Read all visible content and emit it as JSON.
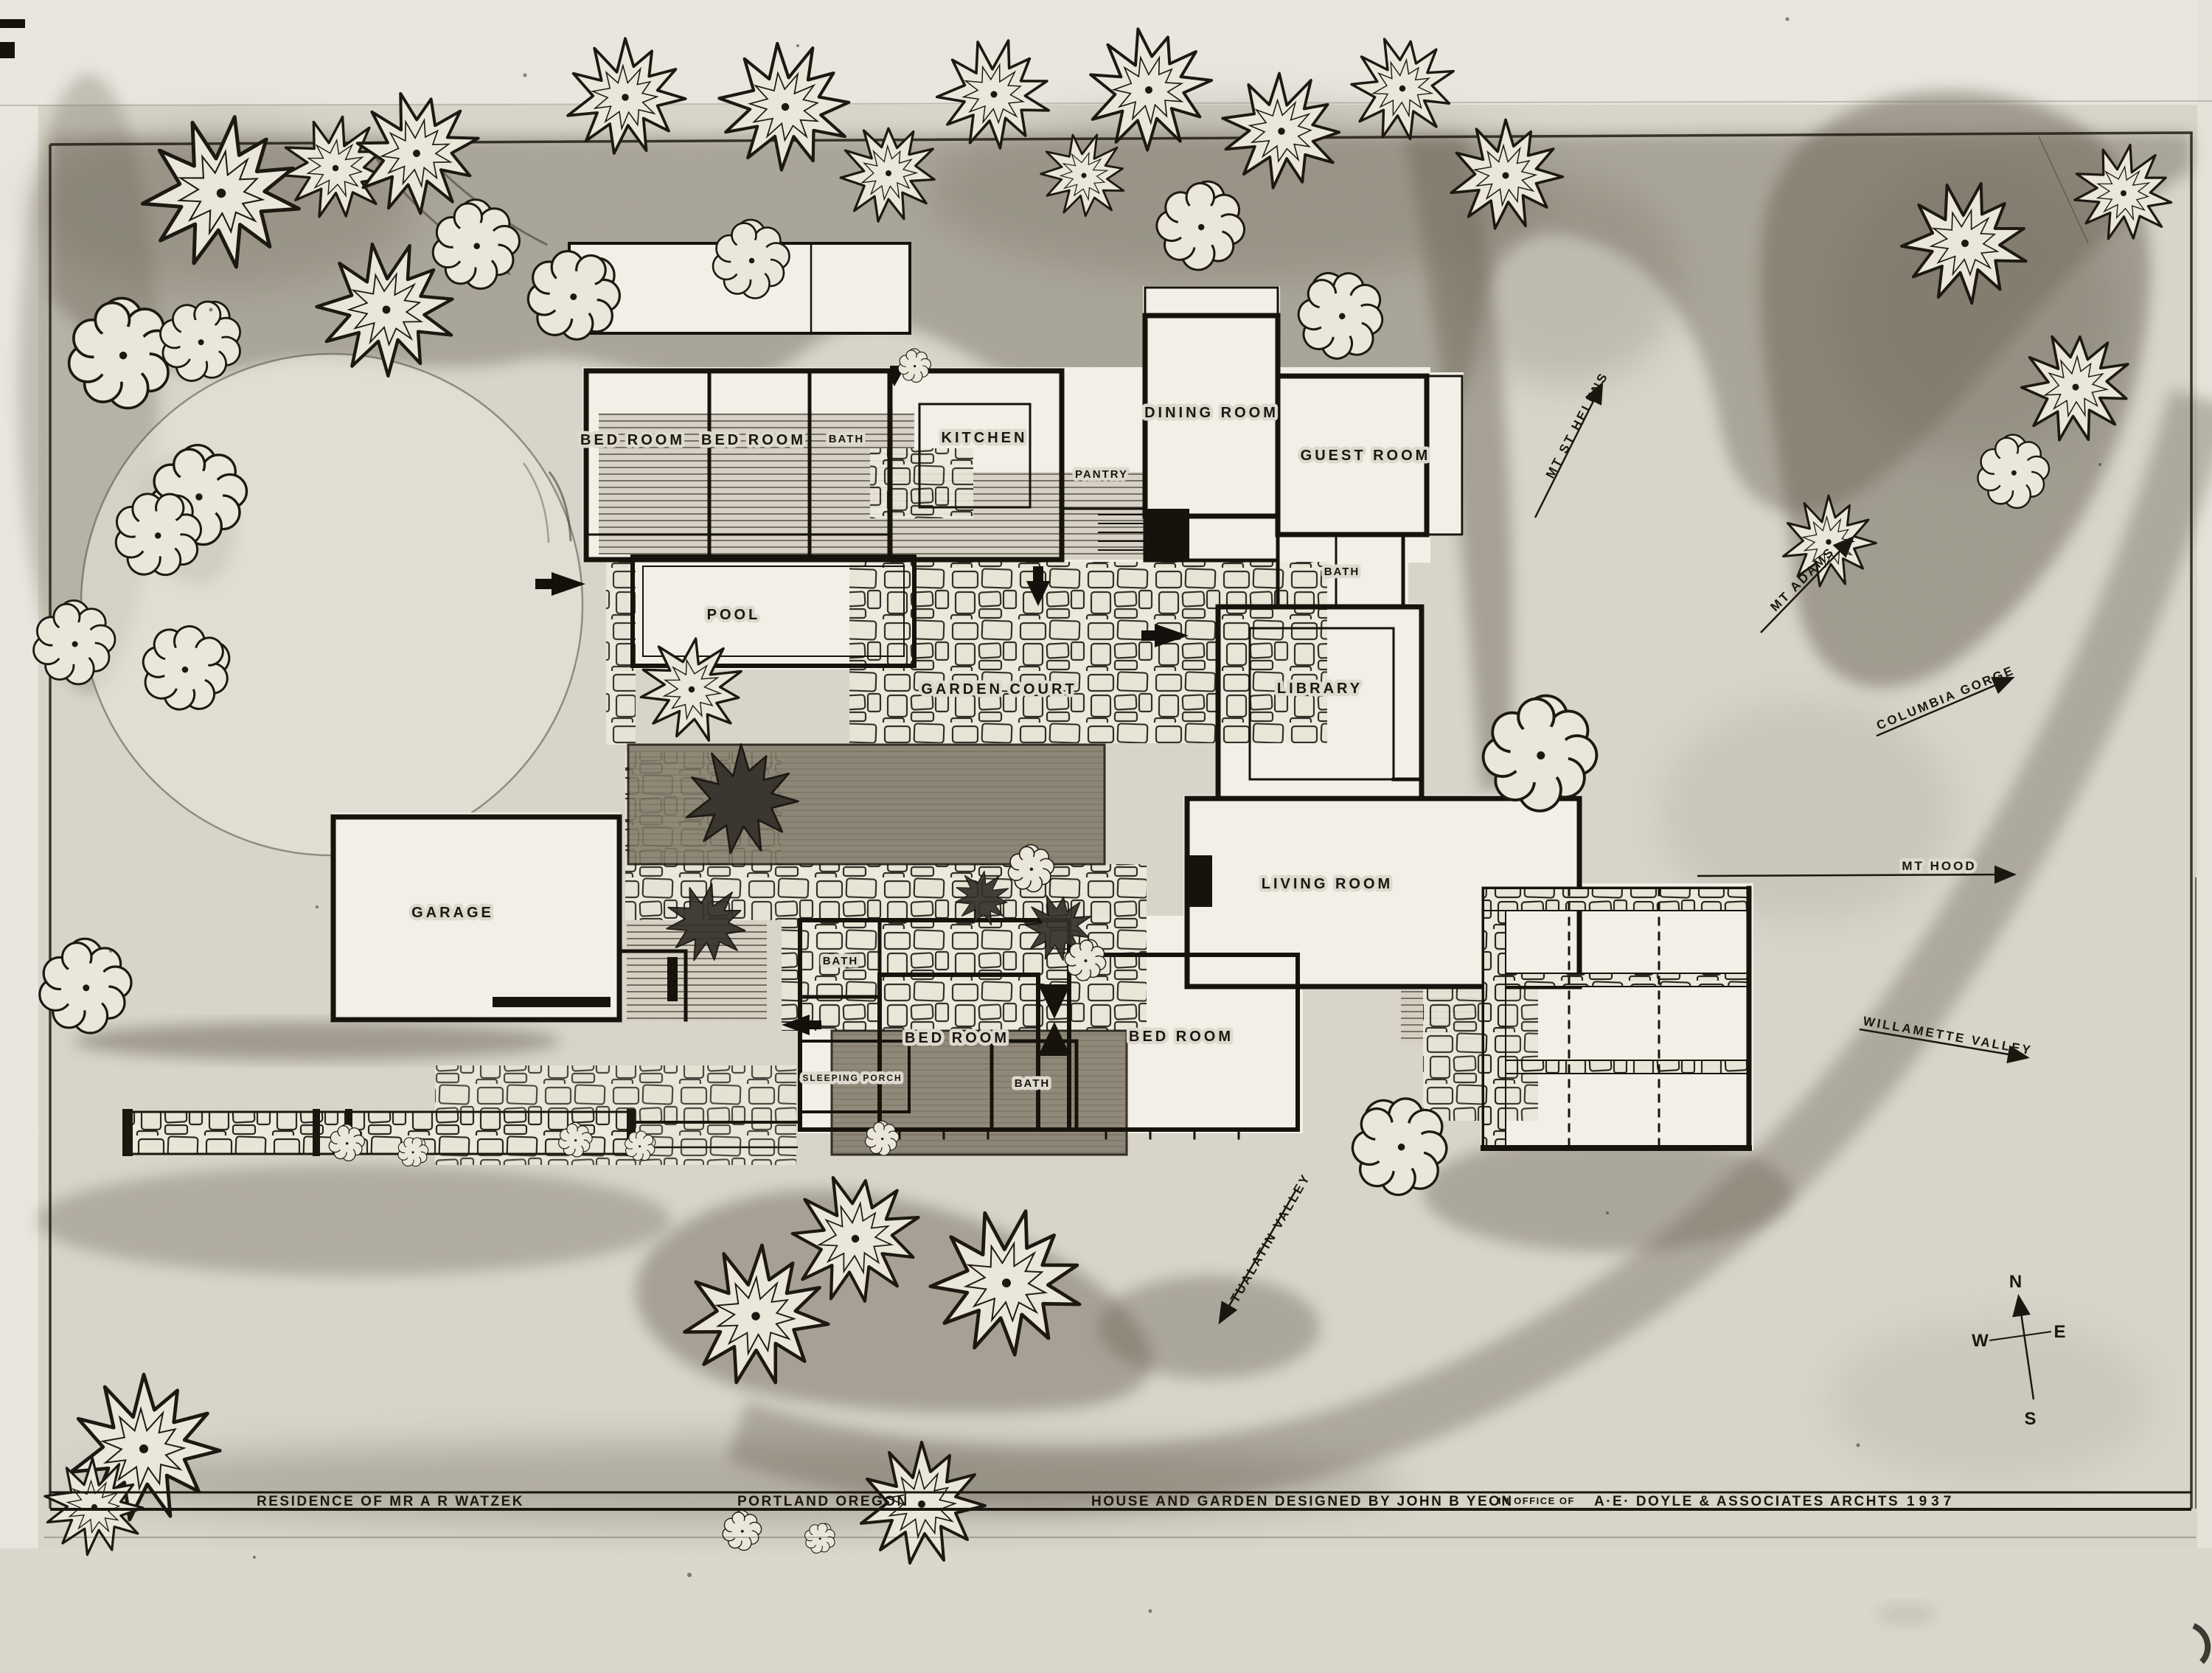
{
  "drawing": {
    "rooms": [
      {
        "id": "bed-room-1",
        "label": "BED ROOM"
      },
      {
        "id": "bed-room-2",
        "label": "BED ROOM"
      },
      {
        "id": "bath-1",
        "label": "BATH"
      },
      {
        "id": "kitchen",
        "label": "KITCHEN"
      },
      {
        "id": "pantry",
        "label": "PANTRY"
      },
      {
        "id": "dining-room",
        "label": "DINING ROOM"
      },
      {
        "id": "guest-room",
        "label": "GUEST  ROOM"
      },
      {
        "id": "bath-2",
        "label": "BATH"
      },
      {
        "id": "pool",
        "label": "POOL"
      },
      {
        "id": "garden-court",
        "label": "GARDEN  COURT"
      },
      {
        "id": "library",
        "label": "LIBRARY"
      },
      {
        "id": "living-room",
        "label": "LIVING  ROOM"
      },
      {
        "id": "garage",
        "label": "GARAGE"
      },
      {
        "id": "bath-3",
        "label": "BATH"
      },
      {
        "id": "bed-room-3",
        "label": "BED  ROOM"
      },
      {
        "id": "bed-room-4",
        "label": "BED  ROOM"
      },
      {
        "id": "sleeping-porch",
        "label": "SLEEPING PORCH"
      },
      {
        "id": "bath-4",
        "label": "BATH"
      }
    ],
    "view_arrows": [
      {
        "id": "mt-st-helens",
        "label": "MT  ST HELENS"
      },
      {
        "id": "mt-adams",
        "label": "MT  ADAMS"
      },
      {
        "id": "columbia-gorge",
        "label": "COLUMBIA  GORGE"
      },
      {
        "id": "mt-hood",
        "label": "MT  HOOD"
      },
      {
        "id": "willamette-valley",
        "label": "WILLAMETTE  VALLEY"
      },
      {
        "id": "tualatin-valley",
        "label": "TUALATIN  VALLEY"
      }
    ],
    "compass": {
      "north": "N",
      "east": "E",
      "south": "S",
      "west": "W"
    },
    "title_block": {
      "residence": "RESIDENCE  OF  MR  A R  WATZEK",
      "location": "PORTLAND  OREGON",
      "credit": "HOUSE AND GARDEN DESIGNED BY JOHN B YEON",
      "office_prefix": "IN OFFICE OF",
      "firm": "A·E· DOYLE & ASSOCIATES ARCHTS",
      "year": "1937"
    },
    "colors": {
      "paper": "#d9d5ca",
      "ink": "#1b160f",
      "shade": "#6b6557",
      "plan_white": "#f2efe7"
    }
  }
}
